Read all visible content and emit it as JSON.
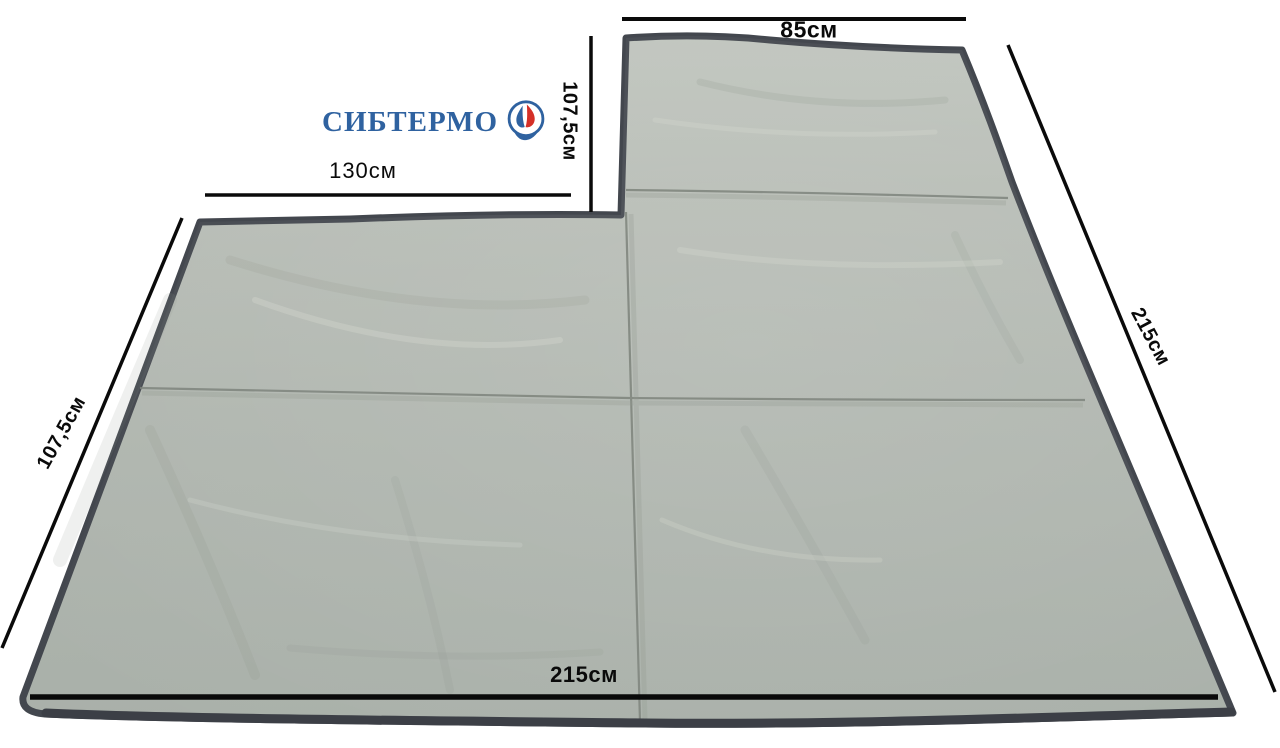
{
  "logo": {
    "brand": "СИБТЕРМО",
    "icon": "flame-drop-hand-circle-icon",
    "colors": {
      "blue": "#2f62a0",
      "red": "#d43028"
    }
  },
  "dimensions": {
    "top_width": "85см",
    "top_section_height": "107,5см",
    "notch_width": "130см",
    "right_side": "215см",
    "left_side": "107,5см",
    "bottom_width": "215см"
  },
  "colors": {
    "background": "#ffffff",
    "fabric_light": "#bcc1ba",
    "fabric_mid": "#b2b8b1",
    "fabric_dark": "#a7aea8",
    "edge_binding": "#43474e",
    "dimension_lines": "#0a0a0a"
  }
}
